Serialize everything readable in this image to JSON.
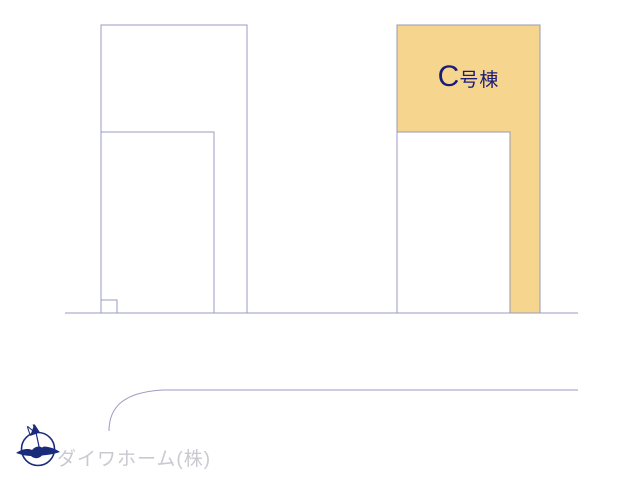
{
  "colors": {
    "line": "#9a9ac4",
    "parcel_fill": "#f6d68e",
    "parcel_stroke": "#9a9aae",
    "label_navy": "#1b1b78",
    "company_gray": "#c9c9d1",
    "compass_navy": "#1a2b7b"
  },
  "plan": {
    "building_label": {
      "prefix": "C",
      "suffix": "号棟"
    }
  },
  "compass": {
    "north_label": "N"
  },
  "footer": {
    "company_name": "ダイワホーム(株)"
  }
}
